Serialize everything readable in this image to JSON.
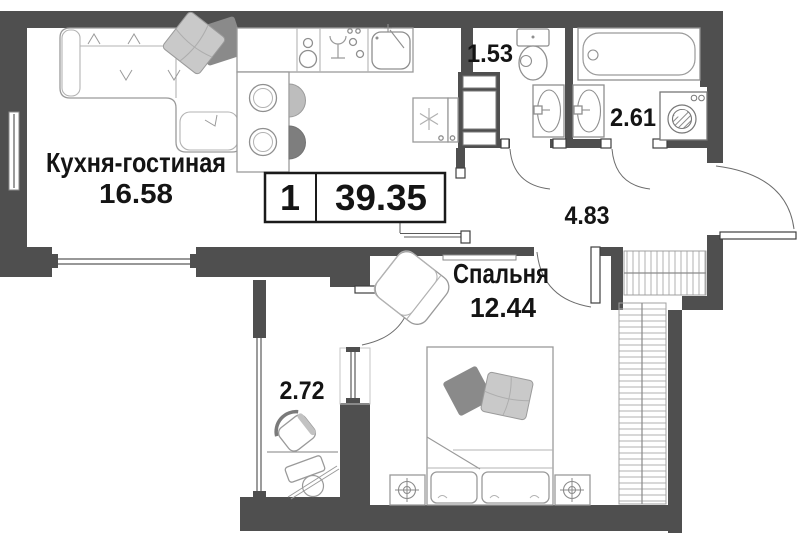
{
  "floor_plan": {
    "unit_badge": {
      "rooms_count": "1",
      "total_area": "39.35"
    },
    "rooms": {
      "kitchen_living": {
        "label": "Кухня-гостиная",
        "area": "16.58"
      },
      "bedroom": {
        "label": "Спальня",
        "area": "12.44"
      },
      "wc": {
        "area": "1.53"
      },
      "bathroom": {
        "area": "2.61"
      },
      "hallway": {
        "area": "4.83"
      },
      "loggia": {
        "area": "2.72"
      }
    },
    "colors": {
      "wall": "#4f4f4f",
      "furniture_outline": "#9a9a9a",
      "pillow_light": "#c9c9c9",
      "pillow_dark": "#8a8a8a",
      "text": "#141414"
    }
  }
}
